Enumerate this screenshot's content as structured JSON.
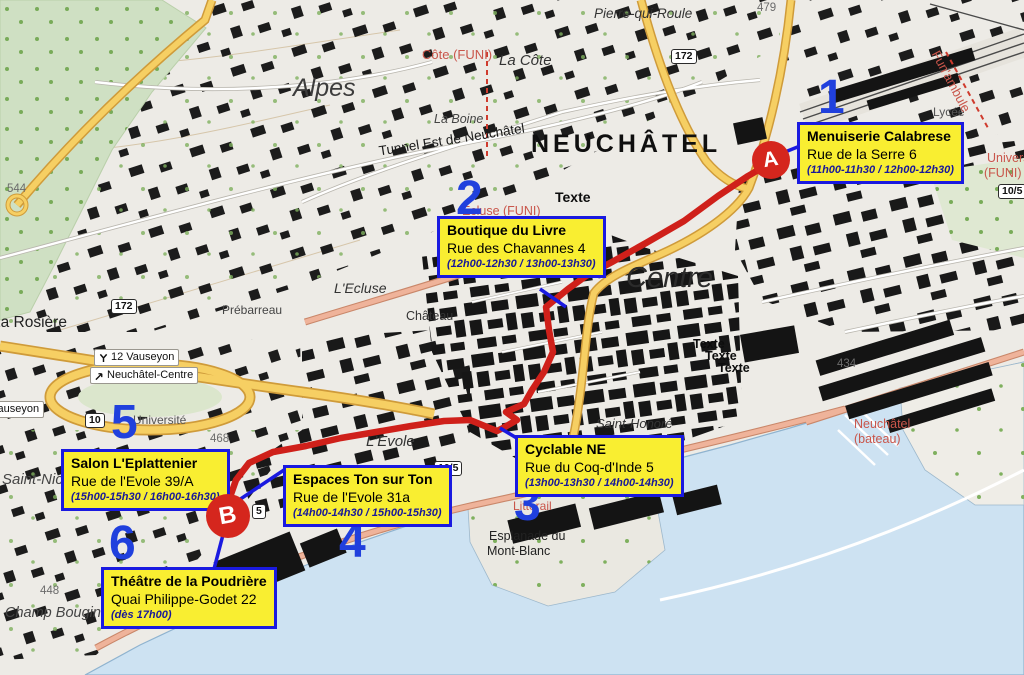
{
  "title": "Plan de tournée Neuchâtel",
  "stops": [
    {
      "number": "1",
      "name": "Menuiserie Calabrese",
      "address": "Rue de la Serre 6",
      "times": "(11h00-11h30 / 12h00-12h30)"
    },
    {
      "number": "2",
      "name": "Boutique du  Livre",
      "address": "Rue des Chavannes 4",
      "times": "(12h00-12h30 / 13h00-13h30)"
    },
    {
      "number": "3",
      "name": "Cyclable NE",
      "address": "Rue du Coq-d'Inde 5",
      "times": "(13h00-13h30 / 14h00-14h30)"
    },
    {
      "number": "4",
      "name": "Espaces Ton sur Ton",
      "address": "Rue de l'Evole 31a",
      "times": "(14h00-14h30 / 15h00-15h30)"
    },
    {
      "number": "5",
      "name": "Salon L'Eplattenier",
      "address": "Rue de l'Evole 39/A",
      "times": "(15h00-15h30 / 16h00-16h30)"
    },
    {
      "number": "6",
      "name": "Théâtre de la Poudrière",
      "address": "Quai Philippe-Godet 22",
      "times": "(dès 17h00)"
    }
  ],
  "markers": {
    "start": "A",
    "end": "B"
  },
  "map_labels": {
    "city": "NEUCHÂTEL",
    "centre": "Centre",
    "alpes": "Alpes",
    "pierre_qui_roule": "Pierre-qui-Roule",
    "cote_funi": "Côte (FUNI)",
    "la_cote": "La Côte",
    "la_boine": "La Boine",
    "tunnel_est": "Tunnel Est de Neuchâtel",
    "texte_a": "Texte",
    "texte_b1": "Texte",
    "texte_b2": "Texte",
    "texte_b3": "Texte",
    "ecluse_funi": "Ecluse (FUNI)",
    "l_ecluse": "L'Ecluse",
    "chateau": "Château",
    "prebarreau": "Prébarreau",
    "saint_honore": "Saint-Honoré",
    "rosiere": "La Rosière",
    "universite_hill": "Université",
    "l_evole": "L'Evole",
    "la_main": "La Main",
    "saint_nicolas": "Saint-Nicolas",
    "champ_bougin": "Champ Bougin",
    "esplanade_1": "Esplanade du",
    "esplanade_2": "Mont-Blanc",
    "place_pury": "Place Pury",
    "littorail": "Littorail",
    "bateau_1": "Neuchâtel",
    "bateau_2": "(bateau)",
    "lycee": "Lycée",
    "funambule": "Fun'ambule",
    "universite_funi_a": "Université",
    "universite_funi_b": "(FUNI)",
    "elev_544": "544",
    "elev_479": "479",
    "elev_468": "468",
    "elev_448": "448",
    "elev_434": "434"
  },
  "road_signs": {
    "s172a": "172",
    "s172b": "172",
    "s10": "10",
    "s105a": "10/5",
    "s105b": "10/5",
    "s5": "5"
  },
  "transit": {
    "vauseyon_12": "12 Vauseyon",
    "neuchatel_centre": "Neuchâtel-Centre",
    "vauseyon": "Vauseyon"
  },
  "colors": {
    "annotation_blue": "#1a1ae0",
    "number_blue": "#2040dd",
    "box_yellow": "#f9ee31",
    "route_red": "#cf201a",
    "marker_red": "#d5261d",
    "transit_red": "#c9564b",
    "lake_blue": "#cde2f2"
  }
}
